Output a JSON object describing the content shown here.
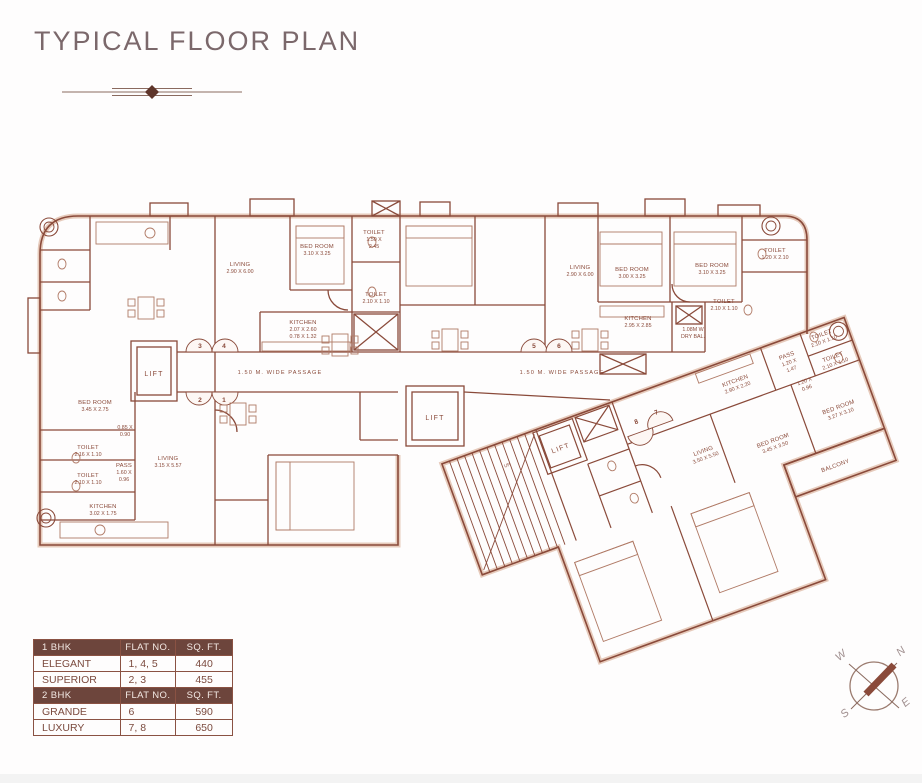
{
  "page": {
    "title": "TYPICAL FLOOR PLAN"
  },
  "plan": {
    "passage_left": "1.50 M. WIDE PASSAGE",
    "passage_right": "1.50 M. WIDE PASSAGE",
    "lift_left": "LIFT",
    "lift_mid": "LIFT",
    "lift_wing": "LIFT",
    "up": "UP",
    "doors": {
      "n1": "1",
      "n2": "2",
      "n3": "3",
      "n4": "4",
      "n5": "5",
      "n6": "6",
      "n7": "7",
      "n8": "8"
    },
    "rooms": {
      "flat2_bedroom": {
        "n": "BED ROOM",
        "d": "3.45 X 2.75"
      },
      "flat2_dim": {
        "n": "0.85 X",
        "d": "0.90"
      },
      "flat2_toilet1": {
        "n": "TOILET",
        "d": "2.16 X 1.10"
      },
      "flat2_pass": {
        "n": "PASS",
        "d": "1.60 X",
        "d2": "0.96"
      },
      "flat2_toilet2": {
        "n": "TOILET",
        "d": "2.10 X 1.10"
      },
      "flat2_kitchen": {
        "n": "KITCHEN",
        "d": "3.02 X 1.75"
      },
      "flat2_living": {
        "n": "LIVING",
        "d": "3.15 X 5.57"
      },
      "flat4_living": {
        "n": "LIVING",
        "d": "2.90 X 6.00"
      },
      "flat4_bedroom": {
        "n": "BED ROOM",
        "d": "3.10 X 3.25"
      },
      "flat4_toilet1": {
        "n": "TOILET",
        "d": "1.50 X",
        "d2": "2.45"
      },
      "flat4_toilet2": {
        "n": "TOILET",
        "d": "2.10 X 1.10"
      },
      "flat4_kitchen": {
        "n": "KITCHEN",
        "d": "2.07 X 2.60",
        "d2": "0.78 X 1.32"
      },
      "flat6_living": {
        "n": "LIVING",
        "d": "2.90 X 6.00"
      },
      "flat6_bedroom1": {
        "n": "BED ROOM",
        "d": "3.00 X 3.25"
      },
      "flat6_bedroom2": {
        "n": "BED ROOM",
        "d": "3.10 X 3.25"
      },
      "flat6_kitchen": {
        "n": "KITCHEN",
        "d": "2.95 X 2.85"
      },
      "flat6_toilet1": {
        "n": "TOILET",
        "d": "1.20 X 2.10"
      },
      "flat6_toilet2": {
        "n": "TOILET",
        "d": "2.10 X 1.10"
      },
      "dry_balcony": {
        "n": "1.08M W",
        "d": "DRY BAL."
      },
      "wing_kitchen": {
        "n": "KITCHEN",
        "d": "2.90 X 2.20"
      },
      "wing_pass": {
        "n": "PASS",
        "d": "1.20 X",
        "d2": "1.47"
      },
      "wing_toilet1": {
        "n": "TOILET",
        "d": "2.10 X 1.10"
      },
      "wing_toilet2": {
        "n": "TOILET",
        "d": "2.10 X 1.10"
      },
      "wing_dim": {
        "n": "1.20 X",
        "d": "0.96"
      },
      "wing_bedroom1": {
        "n": "BED ROOM",
        "d": "3.27 X 3.10"
      },
      "wing_bedroom2": {
        "n": "BED ROOM",
        "d": "3.45 X 3.50"
      },
      "wing_living": {
        "n": "LIVING",
        "d": "3.50 X 5.50"
      },
      "wing_balcony": {
        "n": "BALCONY"
      }
    }
  },
  "legend": {
    "bhk1": {
      "type": "1 BHK",
      "flat_no": "FLAT NO.",
      "sqft": "SQ. FT."
    },
    "rows1": [
      {
        "type": "ELEGANT",
        "flats": "1, 4, 5",
        "sqft": "440"
      },
      {
        "type": "SUPERIOR",
        "flats": "2, 3",
        "sqft": "455"
      }
    ],
    "bhk2": {
      "type": "2 BHK",
      "flat_no": "FLAT NO.",
      "sqft": "SQ. FT."
    },
    "rows2": [
      {
        "type": "GRANDE",
        "flats": "6",
        "sqft": "590"
      },
      {
        "type": "LUXURY",
        "flats": "7, 8",
        "sqft": "650"
      }
    ]
  },
  "compass": {
    "n": "N",
    "e": "E",
    "s": "S",
    "w": "W"
  }
}
